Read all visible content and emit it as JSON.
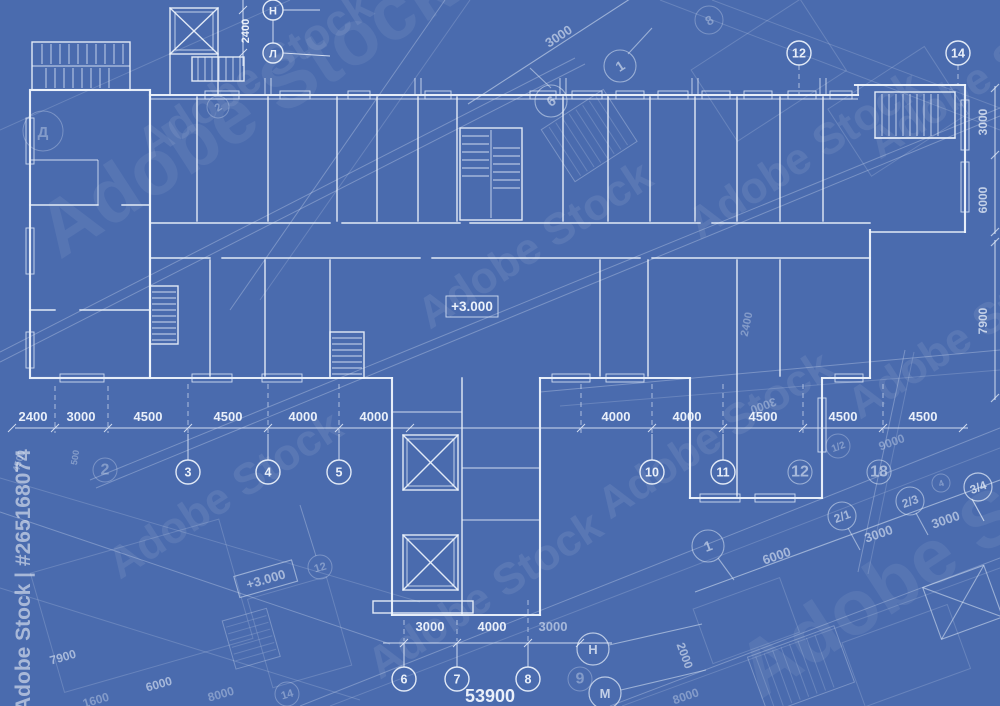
{
  "meta": {
    "type": "architectural-blueprint-floor-plan",
    "colors": {
      "background": "#4a6bae",
      "line_bright": "#eef4fc",
      "line_faint": "#dce7f6",
      "text": "#f2f7fe"
    }
  },
  "watermark": {
    "diagonal": "Adobe Stock",
    "sidebar": "Adobe Stock | #265168074"
  },
  "elevation": {
    "main": "+3.000",
    "overlay": "+3.000"
  },
  "top": {
    "h": "Н",
    "l": "Л",
    "dim_hl": "2400",
    "col12": "12",
    "col14": "14"
  },
  "right_dims": [
    "3000",
    "6000",
    "7900"
  ],
  "main_dims": [
    "2400",
    "3000",
    "4500",
    "4500",
    "4000",
    "4000",
    "4000",
    "4000",
    "4500",
    "4500",
    "4500"
  ],
  "mid_bubbles": [
    "3",
    "4",
    "5",
    "10",
    "11"
  ],
  "mid_faint": {
    "b2": "2",
    "b12": "12",
    "b18": "18"
  },
  "stem_dims": [
    "3000",
    "4000",
    "3000"
  ],
  "stem_bubbles": [
    "6",
    "7",
    "8"
  ],
  "stem_faint_b9": "9",
  "total_dim": "53900",
  "ov_top": {
    "dim3000": "3000",
    "b1": "1",
    "b6": "6",
    "b8": "8",
    "b2": "2",
    "bd": "Д"
  },
  "ov_br": {
    "b21": "2/1",
    "b23": "2/3",
    "b34": "3/4",
    "b1": "1",
    "b12": "1/2",
    "b4": "4",
    "bh": "Н",
    "bm": "М",
    "d6000": "6000",
    "d3000a": "3000",
    "d3000b": "3000",
    "d2000": "2000",
    "d9000": "9000",
    "d8000": "8000",
    "d2400": "2400",
    "d3000m": "3000"
  },
  "ov_bl": {
    "d7900": "7900",
    "d6000": "6000",
    "d8000": "8000",
    "d1600": "1600",
    "d4500": "4500",
    "d500": "500",
    "b12": "12",
    "b14": "14"
  }
}
